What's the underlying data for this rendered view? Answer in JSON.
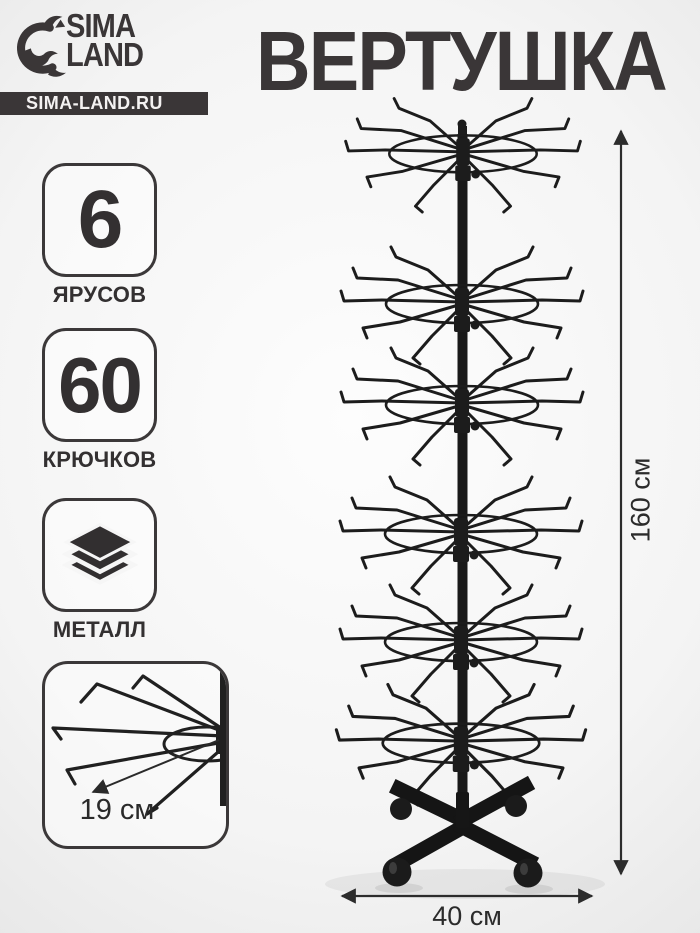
{
  "colors": {
    "ink": "#3a3637",
    "stand": "#1c1c1c",
    "bar_bg": "#3a3637",
    "bar_text": "#f4f2f2"
  },
  "header": {
    "logo_line1": "SIMA",
    "logo_line2": "LAND",
    "site": "SIMA-LAND.RU",
    "title": "ВЕРТУШКА"
  },
  "features": [
    {
      "value": "6",
      "label": "ЯРУСОВ"
    },
    {
      "value": "60",
      "label": "КРЮЧКОВ"
    },
    {
      "value": "",
      "label": "МЕТАЛЛ",
      "icon": "layers-icon"
    }
  ],
  "detail_callout": {
    "measurement": "19 см"
  },
  "dimensions": {
    "height_label": "160 см",
    "width_label": "40 см"
  }
}
